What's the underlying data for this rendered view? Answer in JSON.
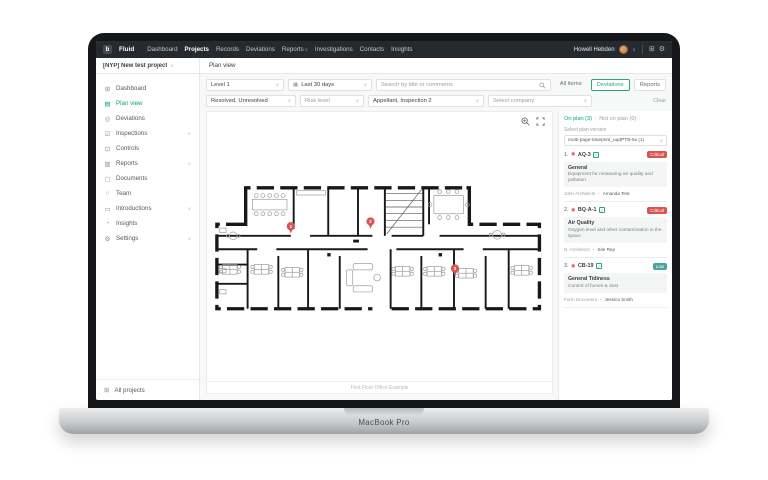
{
  "device": {
    "label": "MacBook Pro"
  },
  "colors": {
    "accent": "#00a67e",
    "critical_red": "#d9534f",
    "low_teal": "#4aa3a3",
    "nav_dark": "#26292d"
  },
  "icons": {
    "chevron": "∨",
    "grid": "⊞",
    "gear": "⚙",
    "calendar": "▦",
    "check": "✓",
    "target": "◉",
    "dot": "•",
    "sep": "|"
  },
  "topnav": {
    "logo_glyph": "b",
    "logo_text": "Fluid",
    "items": [
      "Dashboard",
      "Projects",
      "Records",
      "Deviations",
      "Reports",
      "Investigations",
      "Contacts",
      "Insights"
    ],
    "user_name": "Howell Hebden"
  },
  "projectbar": {
    "project": "[NYP] New test project",
    "breadcrumb": "Plan view"
  },
  "sidebar": {
    "items": [
      {
        "icon": "⊞",
        "label": "Dashboard"
      },
      {
        "icon": "▤",
        "label": "Plan view"
      },
      {
        "icon": "◎",
        "label": "Deviations"
      },
      {
        "icon": "☑",
        "label": "Inspections"
      },
      {
        "icon": "⊡",
        "label": "Controls"
      },
      {
        "icon": "▥",
        "label": "Reports"
      },
      {
        "icon": "▢",
        "label": "Documents"
      },
      {
        "icon": "○",
        "label": "Team"
      },
      {
        "icon": "▭",
        "label": "Introductions"
      },
      {
        "icon": "◔",
        "label": "Insights"
      },
      {
        "icon": "⚙",
        "label": "Settings"
      }
    ],
    "footer": {
      "icon": "⊞",
      "label": "All projects"
    }
  },
  "filters": {
    "level": "Level 1",
    "date_range": "Last 30 days",
    "search_placeholder": "Search by title or comments",
    "tab_all": "All items",
    "tab_deviations": "Deviations",
    "tab_reports": "Reports",
    "status": "Resolved, Unresolved",
    "risk": "Risk level",
    "inspections": "Appellant, Inspection 2",
    "company": "Select company",
    "clear": "Clear"
  },
  "plan": {
    "caption": "First Floor Office Example",
    "pins": [
      {
        "n": "1"
      },
      {
        "n": "2"
      },
      {
        "n": "3"
      }
    ]
  },
  "panel": {
    "tab_on": "On plan (3)",
    "tab_off": "Not on plan (0)",
    "version_label": "Select plan version",
    "version_value": "multi-page-blueprint_uqdPTB-5x (1)",
    "cards": [
      {
        "num": "1.",
        "code": "AQ-3",
        "badge": "Critical",
        "title": "General",
        "desc": "Equipment for measuring air quality and pollution",
        "assignee": "John Architects",
        "reporter": "Amanda Test"
      },
      {
        "num": "2.",
        "code": "BQ-A-1",
        "badge": "Critical",
        "title": "Air Quality",
        "desc": "Oxygen level and other contamination in the space",
        "assignee": "N. Architects",
        "reporter": "Site Rep"
      },
      {
        "num": "3.",
        "code": "CB-19",
        "badge": "Low",
        "title": "General Tidiness",
        "desc": "Control of fumes & dust",
        "assignee": "Form Document",
        "reporter": "Jessica Smith"
      }
    ]
  }
}
